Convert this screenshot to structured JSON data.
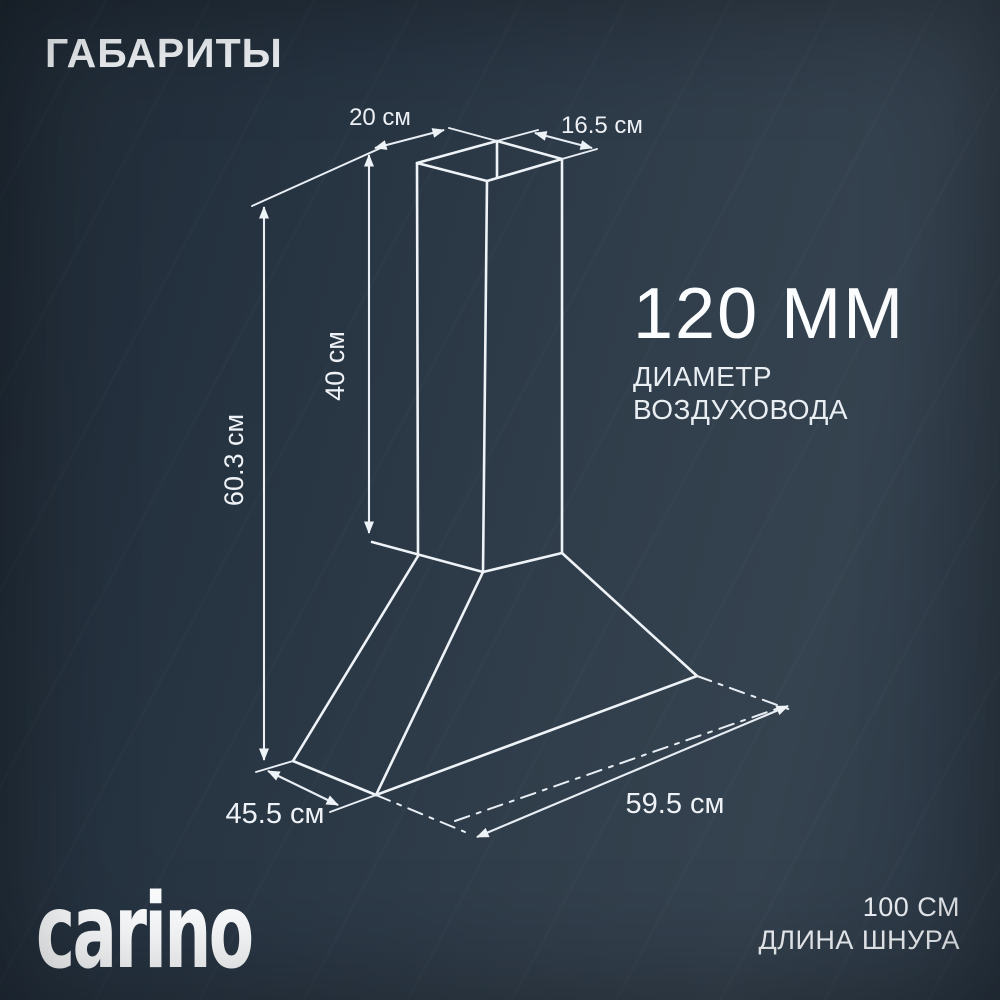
{
  "title": "ГАБАРИТЫ",
  "diagram": {
    "top_width": "20 см",
    "top_depth": "16.5 см",
    "chimney_height": "40 см",
    "total_height": "60.3 см",
    "base_depth": "45.5 см",
    "base_width": "59.5 см"
  },
  "duct": {
    "value": "120 ММ",
    "label_line1": "ДИАМЕТР",
    "label_line2": "ВОЗДУХОВОДА"
  },
  "footer": {
    "brand": "carino",
    "cord_value": "100 СМ",
    "cord_label": "ДЛИНА ШНУРА"
  },
  "colors": {
    "background": "#2b3844",
    "background_dark": "#1f2a35",
    "line": "#ecf1f6",
    "text": "#f4f7fa"
  }
}
